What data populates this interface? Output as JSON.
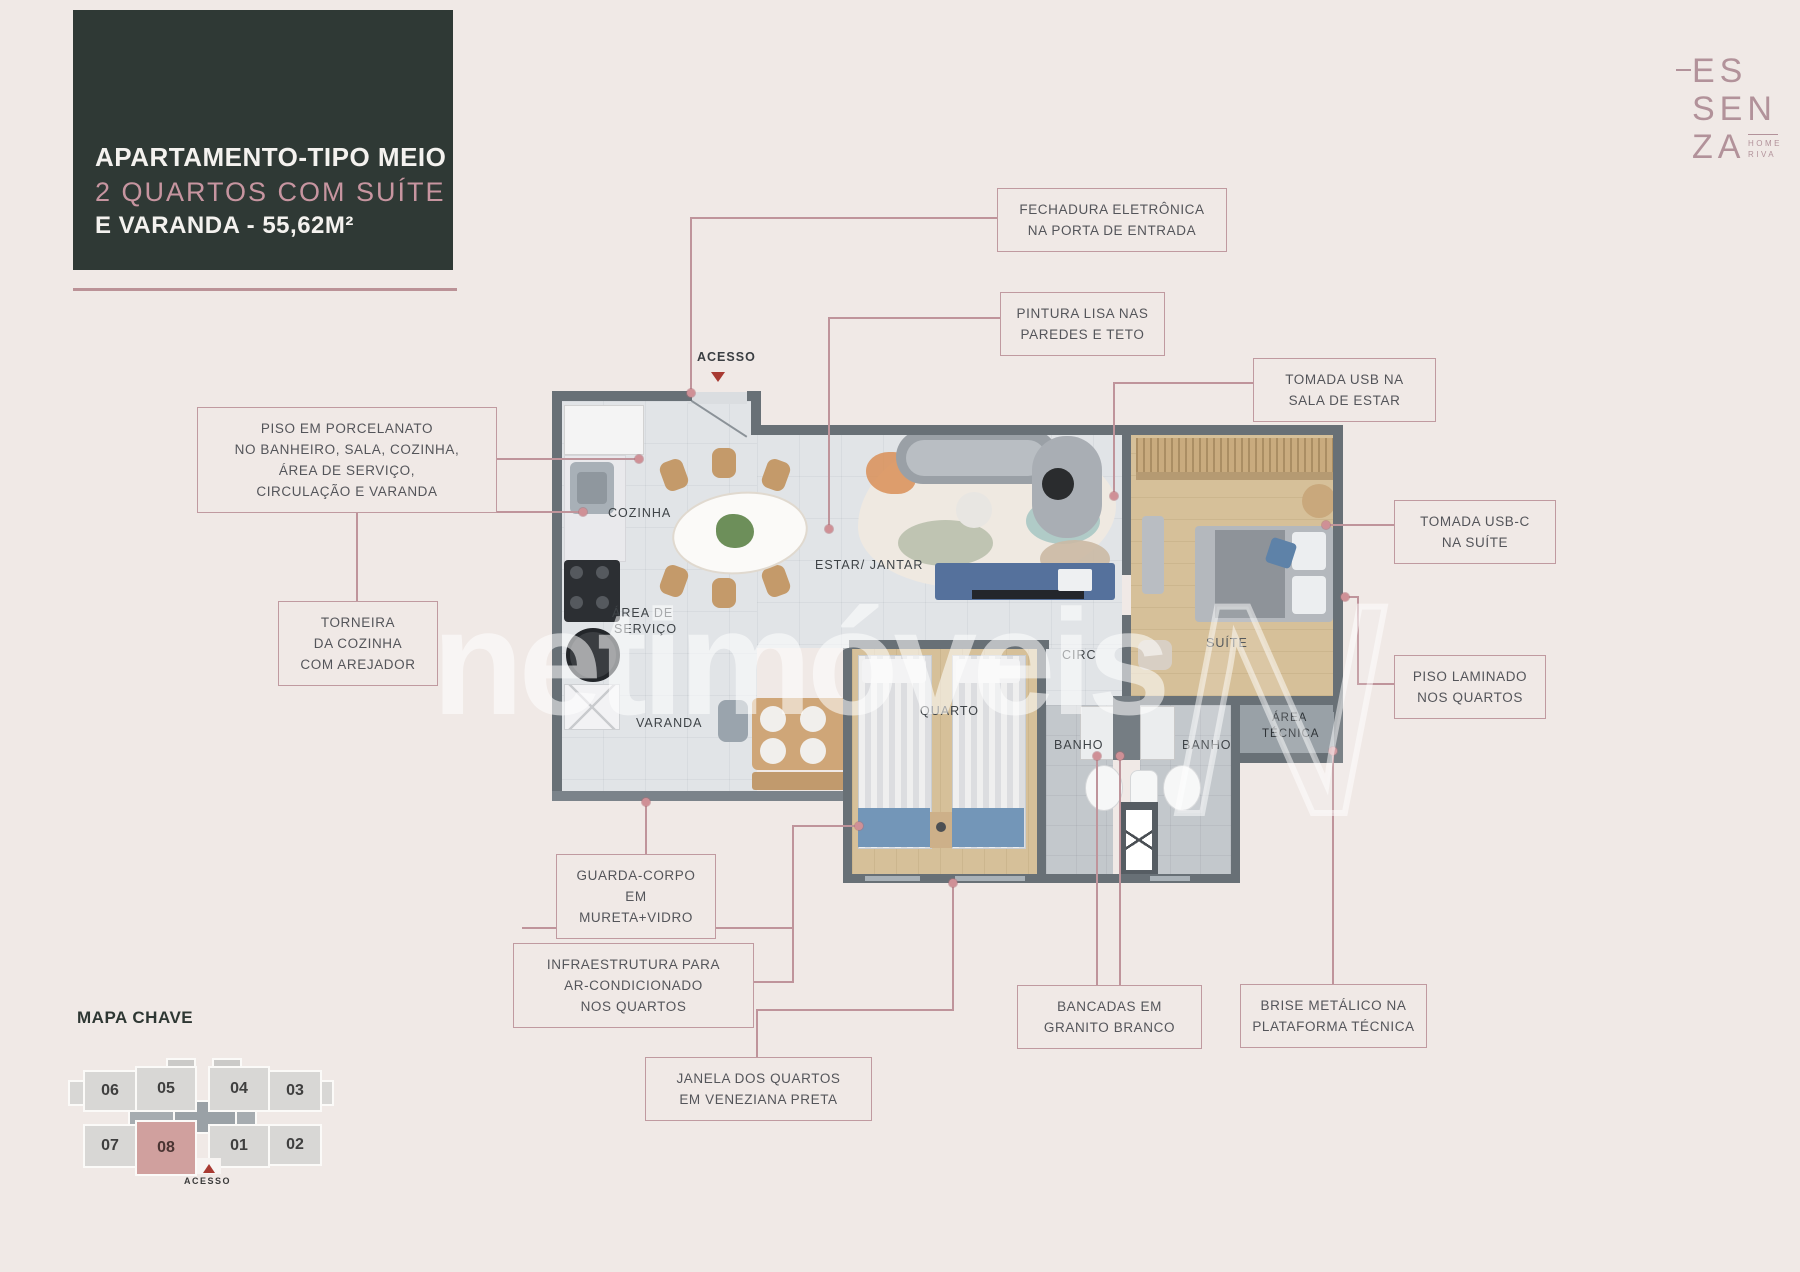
{
  "title_card": {
    "line1": "APARTAMENTO-TIPO MEIO",
    "line2": "2 QUARTOS COM SUÍTE",
    "line3": "E VARANDA - 55,62M²"
  },
  "brand": {
    "l1": "ES",
    "l2": "SEN",
    "l3": "ZA",
    "sub1": "HOME",
    "sub2": "RIVA"
  },
  "watermark": {
    "text": "netimóveis",
    "monogram": "N"
  },
  "rooms": {
    "acesso": "ACESSO",
    "cozinha": "COZINHA",
    "estar": "ESTAR/ JANTAR",
    "servico1": "ÁREA DE",
    "servico2": "SERVIÇO",
    "varanda": "VARANDA",
    "quarto": "QUARTO",
    "circ": "CIRC",
    "suite": "SUÍTE",
    "banho": "BANHO",
    "tecnica1": "ÁREA",
    "tecnica2": "TÉCNICA"
  },
  "callouts": {
    "fechadura": {
      "l1": "FECHADURA ELETRÔNICA",
      "l2": "NA PORTA DE ENTRADA"
    },
    "pintura": {
      "l1": "PINTURA LISA NAS",
      "l2": "PAREDES E TETO"
    },
    "usb_sala": {
      "l1": "TOMADA USB NA",
      "l2": "SALA DE ESTAR"
    },
    "usb_suite": {
      "l1": "TOMADA USB-C",
      "l2": "NA SUÍTE"
    },
    "porcelanato": {
      "l1": "PISO EM PORCELANATO",
      "l2": "NO BANHEIRO, SALA, COZINHA,",
      "l3": "ÁREA DE SERVIÇO,",
      "l4": "CIRCULAÇÃO E VARANDA"
    },
    "torneira": {
      "l1": "TORNEIRA",
      "l2": "DA COZINHA",
      "l3": "COM AREJADOR"
    },
    "laminado": {
      "l1": "PISO LAMINADO",
      "l2": "NOS QUARTOS"
    },
    "guarda": {
      "l1": "GUARDA-CORPO EM",
      "l2": "MURETA+VIDRO"
    },
    "infra": {
      "l1": "INFRAESTRUTURA PARA",
      "l2": "AR-CONDICIONADO",
      "l3": "NOS QUARTOS"
    },
    "janela": {
      "l1": "JANELA DOS QUARTOS",
      "l2": "EM VENEZIANA PRETA"
    },
    "bancadas": {
      "l1": "BANCADAS EM",
      "l2": "GRANITO BRANCO"
    },
    "brise": {
      "l1": "BRISE METÁLICO NA",
      "l2": "PLATAFORMA TÉCNICA"
    }
  },
  "keymap": {
    "title": "MAPA CHAVE",
    "units": [
      "06",
      "05",
      "04",
      "03",
      "07",
      "08",
      "01",
      "02"
    ],
    "highlighted_unit": "08",
    "access_label": "ACESSO"
  },
  "colors": {
    "background": "#f0e9e6",
    "title_bg": "#2f3935",
    "accent_rose": "#bf949b",
    "title_pink": "#c795a0",
    "wall_gray": "#687076",
    "unit_highlight": "#d0a09e",
    "access_red": "#a83a32"
  }
}
